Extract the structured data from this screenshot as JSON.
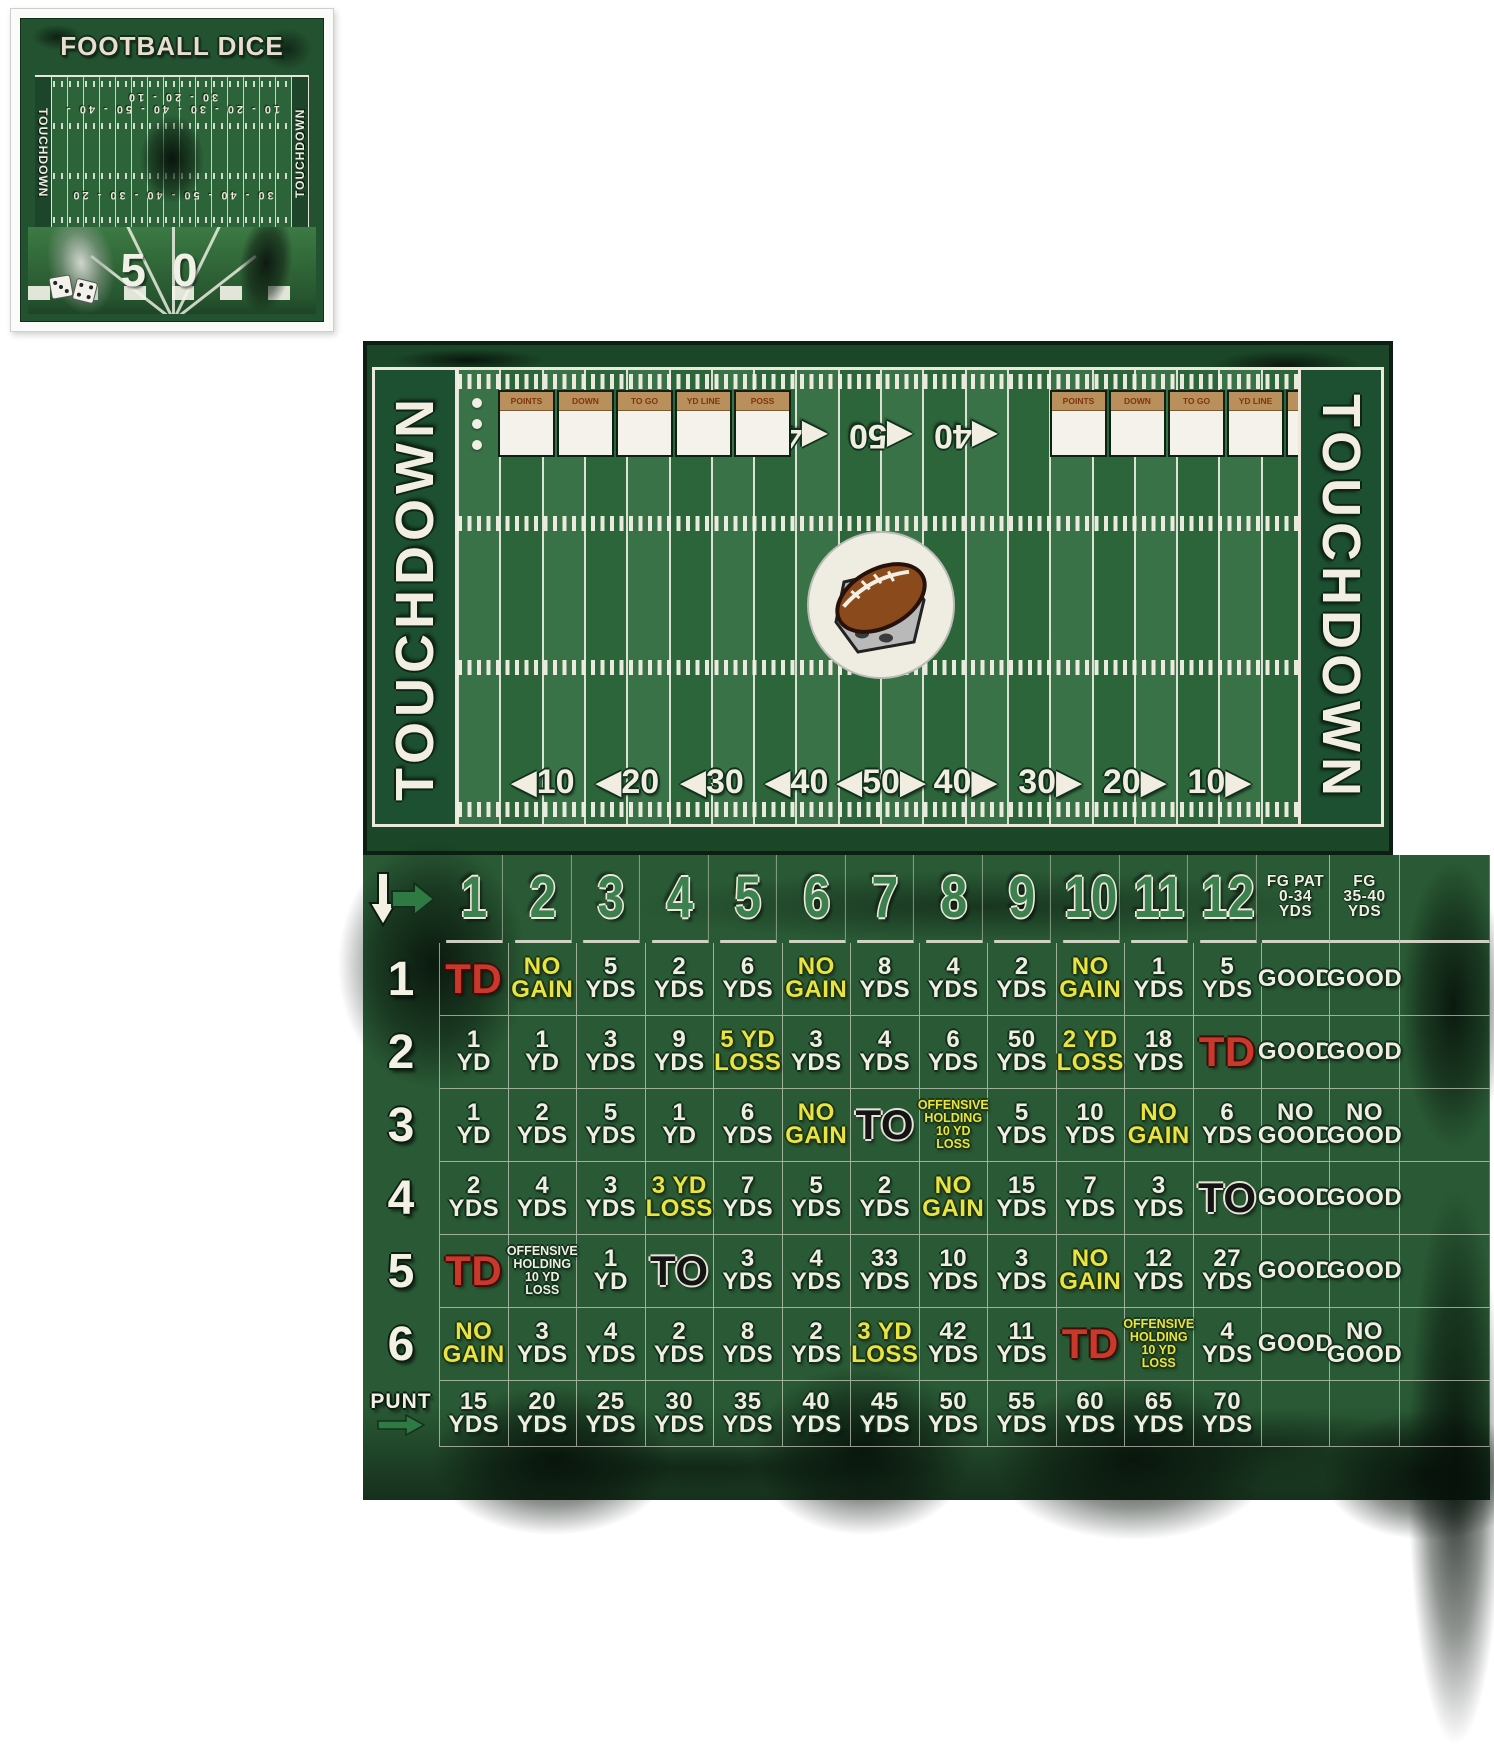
{
  "thumbnail": {
    "title": "FOOTBALL DICE",
    "left_endzone": "TOUCHDOWN",
    "right_endzone": "TOUCHDOWN",
    "top_numbers": "10 - 20 - 30 - 40 - 50 - 40 - 30 - 20 - 10",
    "mid_numbers": "30 - 40 - 50 - 40 - 30 - 20",
    "fifty": "50"
  },
  "board": {
    "left_endzone": "TOUCHDOWN",
    "right_endzone": "TOUCHDOWN",
    "scoreboard_headers": [
      "POINTS",
      "DOWN",
      "TO GO",
      "YD LINE",
      "POSS"
    ],
    "top_numbers": [
      "◀40",
      "◀50",
      "◀40"
    ],
    "bottom_numbers": [
      "◀10",
      "◀20",
      "◀30",
      "◀40",
      "◀50▶",
      "40▶",
      "30▶",
      "20▶",
      "10▶"
    ]
  },
  "table": {
    "column_headers": [
      "1",
      "2",
      "3",
      "4",
      "5",
      "6",
      "7",
      "8",
      "9",
      "10",
      "11",
      "12"
    ],
    "fg_headers": [
      "FG PAT\n0-34\nYDS",
      "FG\n35-40\nYDS"
    ],
    "punt_label": "PUNT",
    "rows": [
      {
        "label": "1",
        "cells": [
          [
            "TD",
            "r"
          ],
          [
            "NO\nGAIN",
            "y"
          ],
          [
            "5\nYDS",
            "w"
          ],
          [
            "2\nYDS",
            "w"
          ],
          [
            "6\nYDS",
            "w"
          ],
          [
            "NO\nGAIN",
            "y"
          ],
          [
            "8\nYDS",
            "w"
          ],
          [
            "4\nYDS",
            "w"
          ],
          [
            "2\nYDS",
            "w"
          ],
          [
            "NO\nGAIN",
            "y"
          ],
          [
            "1\nYDS",
            "w"
          ],
          [
            "5\nYDS",
            "w"
          ],
          [
            "GOOD",
            "w"
          ],
          [
            "GOOD",
            "w"
          ]
        ]
      },
      {
        "label": "2",
        "cells": [
          [
            "1\nYD",
            "w"
          ],
          [
            "1\nYD",
            "w"
          ],
          [
            "3\nYDS",
            "w"
          ],
          [
            "9\nYDS",
            "w"
          ],
          [
            "5 YD\nLOSS",
            "y"
          ],
          [
            "3\nYDS",
            "w"
          ],
          [
            "4\nYDS",
            "w"
          ],
          [
            "6\nYDS",
            "w"
          ],
          [
            "50\nYDS",
            "w"
          ],
          [
            "2 YD\nLOSS",
            "y"
          ],
          [
            "18\nYDS",
            "w"
          ],
          [
            "TD",
            "r"
          ],
          [
            "GOOD",
            "w"
          ],
          [
            "GOOD",
            "w"
          ]
        ]
      },
      {
        "label": "3",
        "cells": [
          [
            "1\nYD",
            "w"
          ],
          [
            "2\nYDS",
            "w"
          ],
          [
            "5\nYDS",
            "w"
          ],
          [
            "1\nYD",
            "w"
          ],
          [
            "6\nYDS",
            "w"
          ],
          [
            "NO\nGAIN",
            "y"
          ],
          [
            "TO",
            "k"
          ],
          [
            "OFFENSIVE\nHOLDING\n10 YD LOSS",
            "ys"
          ],
          [
            "5\nYDS",
            "w"
          ],
          [
            "10\nYDS",
            "w"
          ],
          [
            "NO\nGAIN",
            "y"
          ],
          [
            "6\nYDS",
            "w"
          ],
          [
            "NO\nGOOD",
            "w"
          ],
          [
            "NO\nGOOD",
            "w"
          ]
        ]
      },
      {
        "label": "4",
        "cells": [
          [
            "2\nYDS",
            "w"
          ],
          [
            "4\nYDS",
            "w"
          ],
          [
            "3\nYDS",
            "w"
          ],
          [
            "3 YD\nLOSS",
            "y"
          ],
          [
            "7\nYDS",
            "w"
          ],
          [
            "5\nYDS",
            "w"
          ],
          [
            "2\nYDS",
            "w"
          ],
          [
            "NO\nGAIN",
            "y"
          ],
          [
            "15\nYDS",
            "w"
          ],
          [
            "7\nYDS",
            "w"
          ],
          [
            "3\nYDS",
            "w"
          ],
          [
            "TO",
            "k"
          ],
          [
            "GOOD",
            "w"
          ],
          [
            "GOOD",
            "w"
          ]
        ]
      },
      {
        "label": "5",
        "cells": [
          [
            "TD",
            "r"
          ],
          [
            "OFFENSIVE\nHOLDING\n10 YD LOSS",
            "ws"
          ],
          [
            "1\nYD",
            "w"
          ],
          [
            "TO",
            "k"
          ],
          [
            "3\nYDS",
            "w"
          ],
          [
            "4\nYDS",
            "w"
          ],
          [
            "33\nYDS",
            "w"
          ],
          [
            "10\nYDS",
            "w"
          ],
          [
            "3\nYDS",
            "w"
          ],
          [
            "NO\nGAIN",
            "y"
          ],
          [
            "12\nYDS",
            "w"
          ],
          [
            "27\nYDS",
            "w"
          ],
          [
            "GOOD",
            "w"
          ],
          [
            "GOOD",
            "w"
          ]
        ]
      },
      {
        "label": "6",
        "cells": [
          [
            "NO\nGAIN",
            "y"
          ],
          [
            "3\nYDS",
            "w"
          ],
          [
            "4\nYDS",
            "w"
          ],
          [
            "2\nYDS",
            "w"
          ],
          [
            "8\nYDS",
            "w"
          ],
          [
            "2\nYDS",
            "w"
          ],
          [
            "3 YD\nLOSS",
            "y"
          ],
          [
            "42\nYDS",
            "w"
          ],
          [
            "11\nYDS",
            "w"
          ],
          [
            "TD",
            "r"
          ],
          [
            "OFFENSIVE\nHOLDING\n10 YD LOSS",
            "ys"
          ],
          [
            "4\nYDS",
            "w"
          ],
          [
            "GOOD",
            "w"
          ],
          [
            "NO\nGOOD",
            "w"
          ]
        ]
      },
      {
        "label": "PUNT",
        "cells": [
          [
            "15\nYDS",
            "w"
          ],
          [
            "20\nYDS",
            "w"
          ],
          [
            "25\nYDS",
            "w"
          ],
          [
            "30\nYDS",
            "w"
          ],
          [
            "35\nYDS",
            "w"
          ],
          [
            "40\nYDS",
            "w"
          ],
          [
            "45\nYDS",
            "w"
          ],
          [
            "50\nYDS",
            "w"
          ],
          [
            "55\nYDS",
            "w"
          ],
          [
            "60\nYDS",
            "w"
          ],
          [
            "65\nYDS",
            "w"
          ],
          [
            "70\nYDS",
            "w"
          ],
          [
            "",
            ""
          ],
          [
            "",
            ""
          ]
        ]
      }
    ]
  },
  "colors": {
    "field_green": "#2f6b3d",
    "dark_green": "#1b4728",
    "table_green": "#2a5a35",
    "cream": "#f1eee1",
    "yellow": "#e9e344",
    "td_red": "#c8382b",
    "to_black": "#141414",
    "header_green": "#3c8050",
    "scoreboard_tan": "#b98f5c",
    "scoreboard_brown_text": "#7e3510"
  }
}
